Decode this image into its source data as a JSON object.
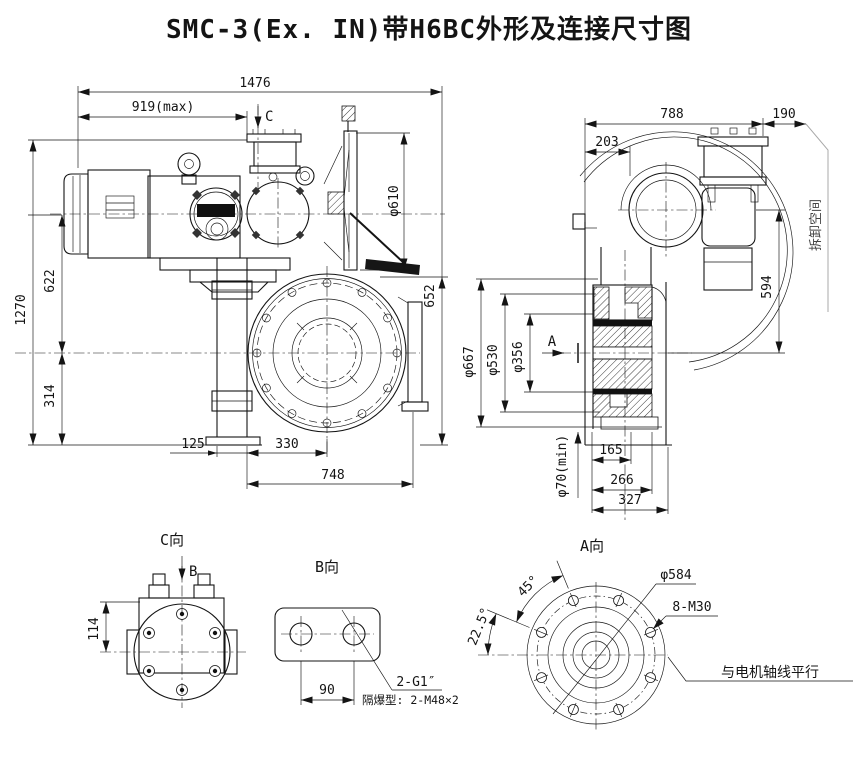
{
  "title": "SMC-3(Ex. IN)带H6BC外形及连接尺寸图",
  "front_view": {
    "dim_1476": "1476",
    "dim_919max": "919(max)",
    "c_label": "C",
    "dim_phi610": "φ610",
    "dim_652": "652",
    "dim_1270": "1270",
    "dim_622": "622",
    "dim_314": "314",
    "dim_125": "125",
    "dim_330": "330",
    "dim_748": "748"
  },
  "side_view": {
    "dim_788": "788",
    "dim_190": "190",
    "dim_203": "203",
    "dim_594": "594",
    "dim_phi667": "φ667",
    "dim_phi530": "φ530",
    "dim_phi356": "φ356",
    "a_label": "A",
    "dim_phi70min": "φ70(min)",
    "dim_165": "165",
    "dim_266": "266",
    "dim_327": "327",
    "removal_space": "拆卸空间"
  },
  "view_c": {
    "label": "C向",
    "b_label": "B",
    "dim_114": "114"
  },
  "view_b": {
    "label": "B向",
    "dim_90": "90",
    "conduit": "2-G1″",
    "note": "隔爆型: 2-M48×2"
  },
  "view_a": {
    "label": "A向",
    "angle_45": "45°",
    "angle_22_5": "22.5°",
    "phi584": "φ584",
    "bolts": "8-M30",
    "parallel_note": "与电机轴线平行"
  }
}
